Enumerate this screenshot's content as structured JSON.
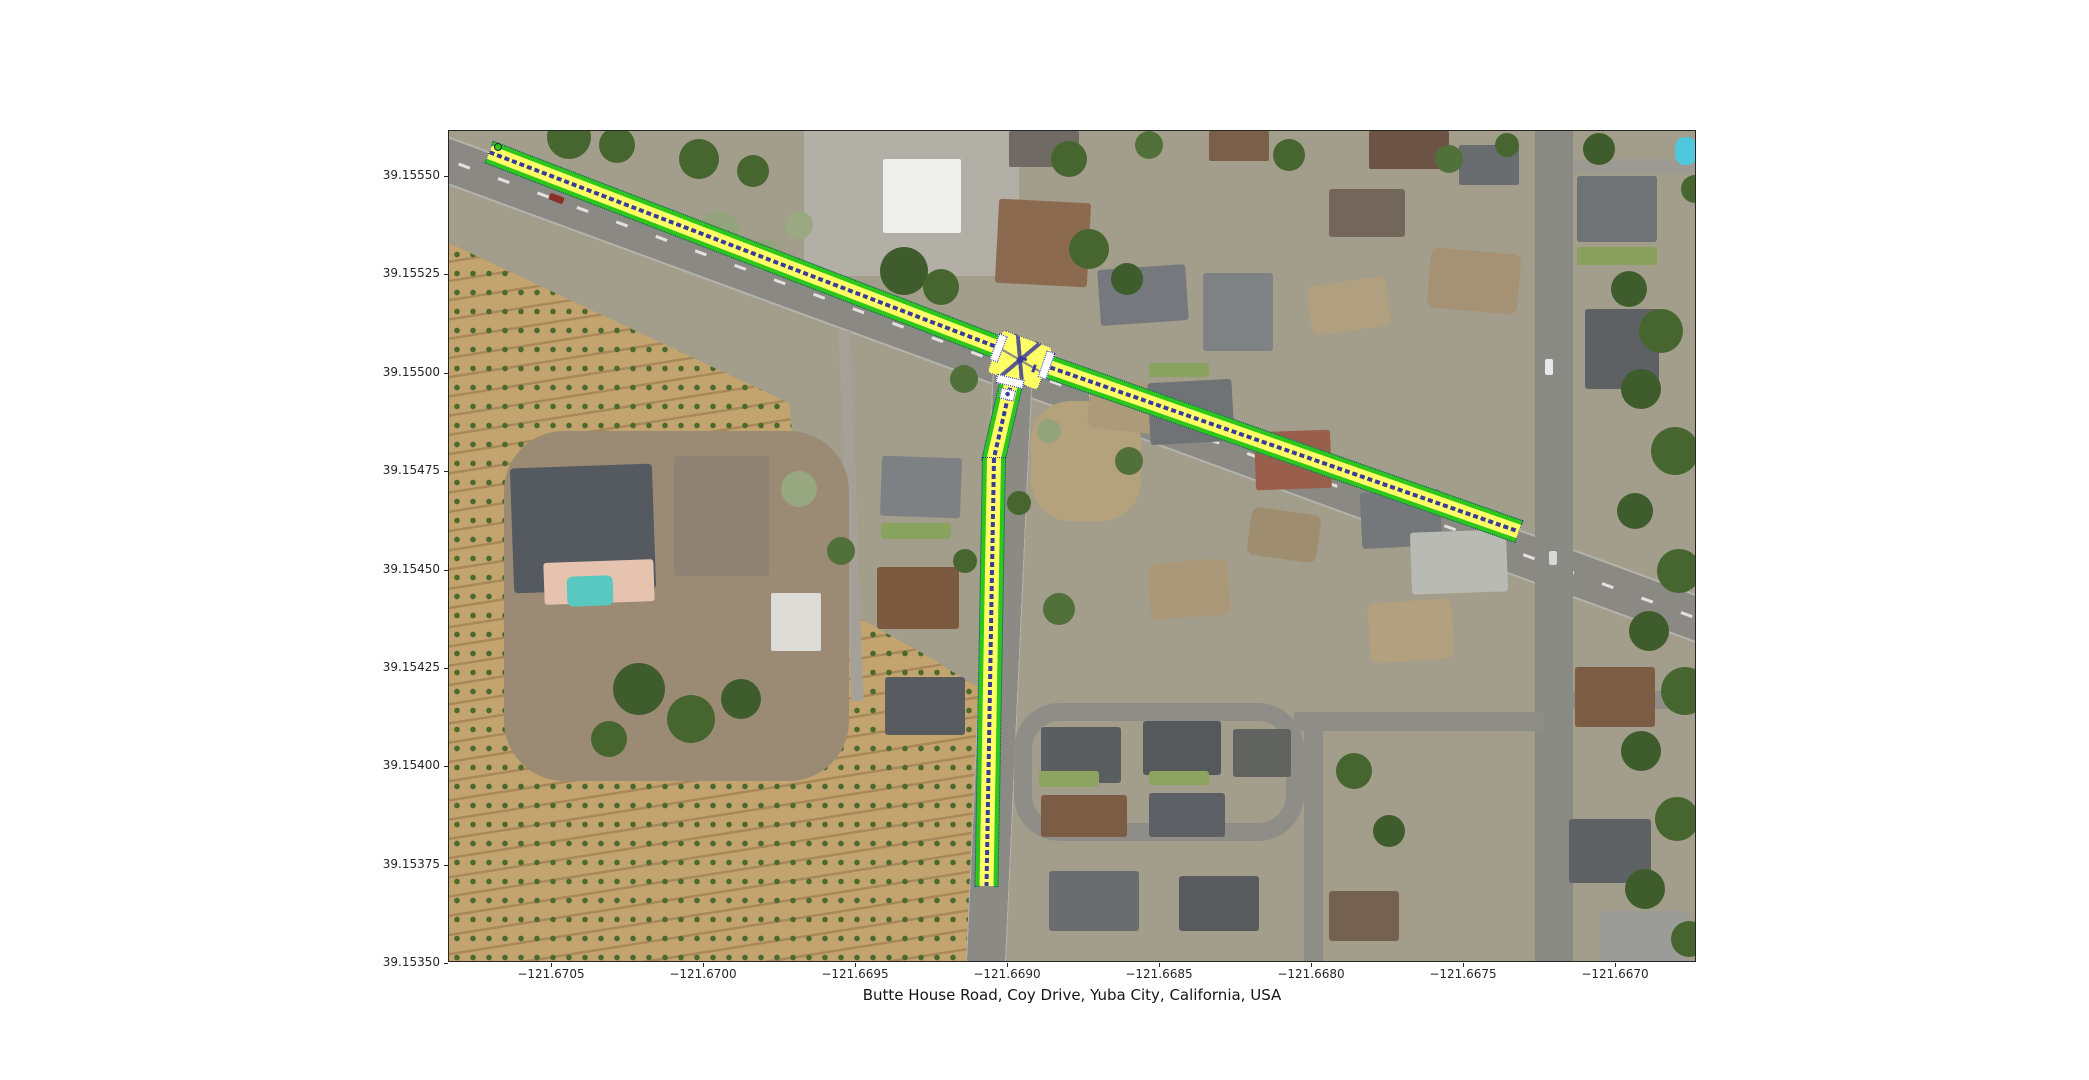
{
  "figure": {
    "title": "Butte House Road, Coy Drive, Yuba City, California, USA",
    "x_axis": {
      "ticks": [
        "−121.6705",
        "−121.6700",
        "−121.6695",
        "−121.6690",
        "−121.6685",
        "−121.6680",
        "−121.6675",
        "−121.6670"
      ]
    },
    "y_axis": {
      "ticks": [
        "39.15550",
        "39.15525",
        "39.15500",
        "39.15475",
        "39.15450",
        "39.15425",
        "39.15400",
        "39.15375",
        "39.15350"
      ]
    },
    "map": {
      "highlighted_roads": [
        "Butte House Road",
        "Coy Drive"
      ],
      "junction_approx": {
        "lon": -121.669,
        "lat": 39.15505
      },
      "style": {
        "lane_green": "#2fc61c",
        "lane_yellow": "#ffff66",
        "divider_navy": "#3b3b99",
        "outline_navy": "#2d2da0",
        "crosswalk_white": "#ffffff"
      }
    }
  }
}
